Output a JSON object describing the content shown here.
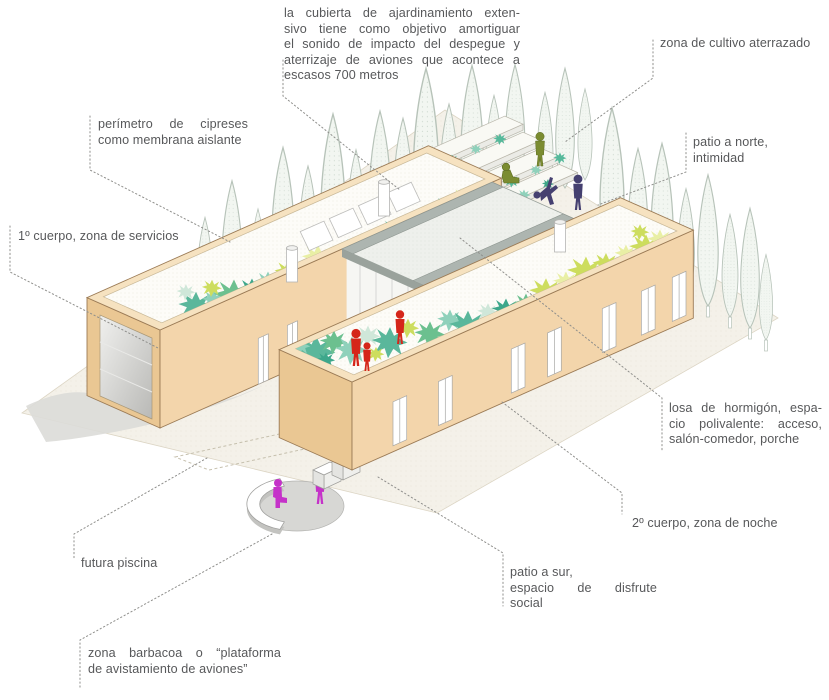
{
  "diagram": {
    "labels": {
      "roof_garden": {
        "lines": [
          "la cubierta de ajardinamiento exten-",
          "sivo tiene como objetivo amortiguar",
          "el sonido de impacto del despegue y",
          "aterrizaje de aviones que acontece a",
          "escasos 700 metros"
        ]
      },
      "terraced_cultivation": {
        "text": "zona de cultivo aterrazado"
      },
      "cypress_perimeter": {
        "lines": [
          "perímetro de cipreses",
          "como membrana aislante"
        ]
      },
      "body1": {
        "text": "1º cuerpo, zona de servicios"
      },
      "north_patio": {
        "lines": [
          "patio a norte,",
          "intimidad"
        ]
      },
      "concrete_slab": {
        "lines": [
          "losa de hormigón, espa-",
          "cio polivalente: acceso,",
          "salón-comedor, porche"
        ]
      },
      "body2": {
        "text": "2º cuerpo, zona de noche"
      },
      "south_patio": {
        "lines": [
          "patio a sur,",
          "espacio de disfrute",
          "social"
        ]
      },
      "future_pool": {
        "text": "futura piscina"
      },
      "barbecue": {
        "lines": [
          "zona barbacoa o “plataforma",
          "de avistamiento de aviones”"
        ]
      }
    },
    "colors": {
      "wall": "#f3d5ab",
      "wall_shade": "#eac793",
      "parapet": "#f6e2c0",
      "roof_bed": "#fdfcf8",
      "slab": "#adb5b0",
      "ground": "#f4f1e9",
      "driveway": "#dbdbd8",
      "vegetation_teal": "#5ab79b",
      "vegetation_lime": "#cddd5e",
      "figure_red": "#d5261a",
      "figure_purple": "#454070",
      "figure_green": "#7b8c31",
      "figure_magenta": "#c532c9",
      "text": "#57585a",
      "leader": "#8f8f8c"
    }
  }
}
